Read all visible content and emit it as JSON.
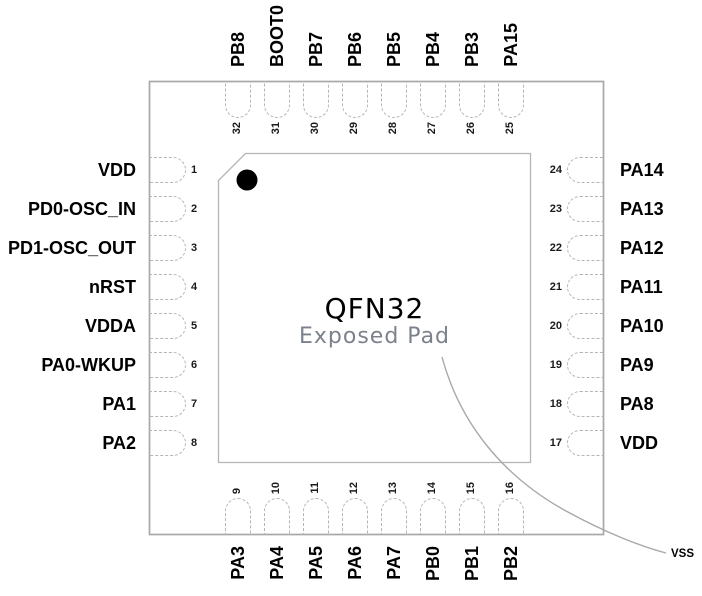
{
  "figure": {
    "package_label": "QFN32",
    "exposed_pad_label": "Exposed Pad",
    "exposed_pad_net": "VSS"
  },
  "colors": {
    "package_outline": "#a8a8a8",
    "die_outline": "#b5b5b5",
    "pin_dash": "#b5b5b5",
    "pin1_marker": "#000000",
    "label_text": "#000000",
    "exposed_pad_text": "#7b828c",
    "leader_line": "#a9a9a9"
  },
  "pins": {
    "top": [
      {
        "num": 32,
        "label": "PB8"
      },
      {
        "num": 31,
        "label": "BOOT0"
      },
      {
        "num": 30,
        "label": "PB7"
      },
      {
        "num": 29,
        "label": "PB6"
      },
      {
        "num": 28,
        "label": "PB5"
      },
      {
        "num": 27,
        "label": "PB4"
      },
      {
        "num": 26,
        "label": "PB3"
      },
      {
        "num": 25,
        "label": "PA15"
      }
    ],
    "left": [
      {
        "num": 1,
        "label": "VDD"
      },
      {
        "num": 2,
        "label": "PD0-OSC_IN"
      },
      {
        "num": 3,
        "label": "PD1-OSC_OUT"
      },
      {
        "num": 4,
        "label": "nRST"
      },
      {
        "num": 5,
        "label": "VDDA"
      },
      {
        "num": 6,
        "label": "PA0-WKUP"
      },
      {
        "num": 7,
        "label": "PA1"
      },
      {
        "num": 8,
        "label": "PA2"
      }
    ],
    "right": [
      {
        "num": 24,
        "label": "PA14"
      },
      {
        "num": 23,
        "label": "PA13"
      },
      {
        "num": 22,
        "label": "PA12"
      },
      {
        "num": 21,
        "label": "PA11"
      },
      {
        "num": 20,
        "label": "PA10"
      },
      {
        "num": 19,
        "label": "PA9"
      },
      {
        "num": 18,
        "label": "PA8"
      },
      {
        "num": 17,
        "label": "VDD"
      }
    ],
    "bottom": [
      {
        "num": 9,
        "label": "PA3"
      },
      {
        "num": 10,
        "label": "PA4"
      },
      {
        "num": 11,
        "label": "PA5"
      },
      {
        "num": 12,
        "label": "PA6"
      },
      {
        "num": 13,
        "label": "PA7"
      },
      {
        "num": 14,
        "label": "PB0"
      },
      {
        "num": 15,
        "label": "PB1"
      },
      {
        "num": 16,
        "label": "PB2"
      }
    ]
  }
}
